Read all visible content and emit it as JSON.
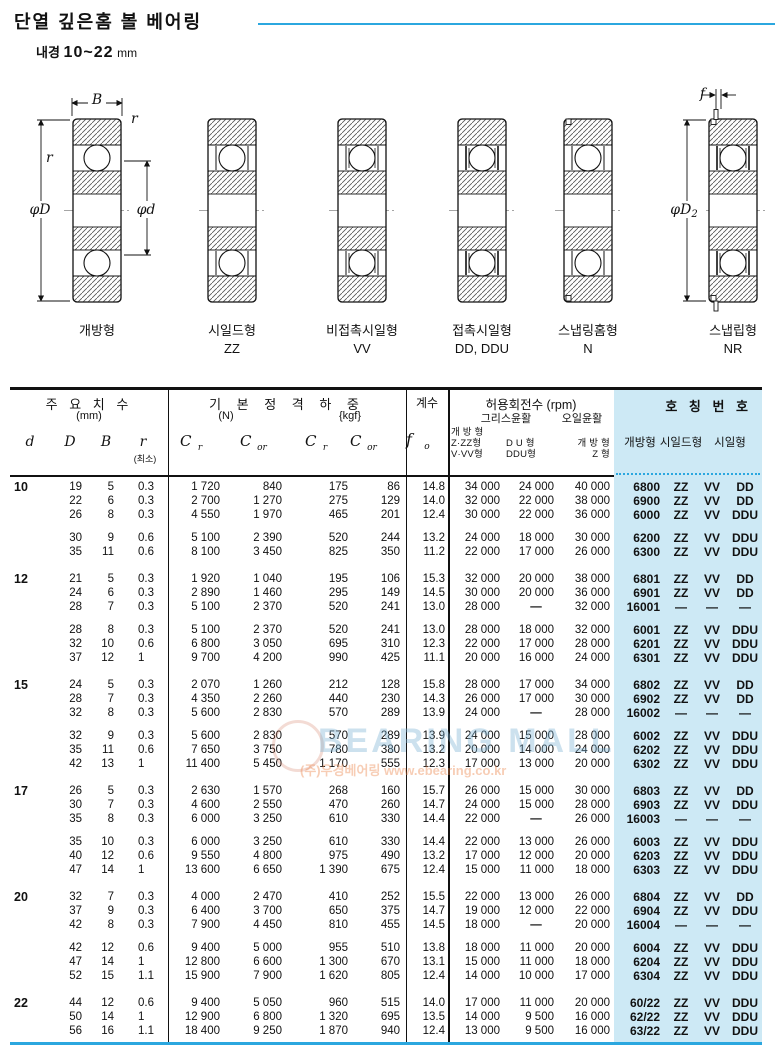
{
  "title": {
    "main": "단열 깊은홈 볼 베어링",
    "sub_label": "내경",
    "sub_range": "10~22",
    "sub_unit": "mm"
  },
  "diagrams": [
    {
      "label": "개방형",
      "code": ""
    },
    {
      "label": "시일드형",
      "code": "ZZ"
    },
    {
      "label": "비접촉시일형",
      "code": "VV"
    },
    {
      "label": "접촉시일형",
      "code": "DD, DDU"
    },
    {
      "label": "스냅링홈형",
      "code": "N"
    },
    {
      "label": "스냅립형",
      "code": "NR"
    }
  ],
  "dims": {
    "B": "B",
    "r_top": "r",
    "r_left": "r",
    "phiD": "φD",
    "phid": "φd",
    "f": "f",
    "phiD2_sym": "φD",
    "phiD2_sub": "2"
  },
  "header": {
    "dims_title": "주 요 치 수",
    "dims_unit": "(mm)",
    "col_d": "d",
    "col_D": "D",
    "col_B": "B",
    "col_r": "r",
    "col_r_min": "(최소)",
    "load_title": "기 본 정 격 하 중",
    "load_unit_n": "(N)",
    "load_unit_kgf": "{kgf}",
    "c_sym": "C",
    "c_sub_r": "r",
    "c_sub_or": "or",
    "factor_title": "계수",
    "f_sym": "f",
    "f_sub": "o",
    "rpm_title": "허용회전수 (rpm)",
    "grease": "그리스윤활",
    "oil": "오일윤활",
    "g1_l1": "개 방 형",
    "g1_l2": "Z·ZZ형",
    "g1_l3": "V·VV형",
    "g2_l1": "D U 형",
    "g2_l2": "DDU형",
    "o_l1": "개 방 형",
    "o_l2": "Z 형",
    "no_title": "호 칭 번 호",
    "no_open": "개방형",
    "no_shield": "시일드형",
    "no_seal": "시일형"
  },
  "colors": {
    "accent": "#2BA7DF",
    "number_panel_bg": "#CDE9F5"
  },
  "watermark": {
    "line1": "BEARING MALL",
    "line2": "(주)우경베어링  www.ebearing.co.kr"
  },
  "table": {
    "groups": [
      {
        "d": "10",
        "subgroups": [
          {
            "rows": [
              {
                "D": "19",
                "B": "5",
                "r": "0.3",
                "cr": "1 720",
                "cor": "840",
                "crk": "175",
                "cork": "86",
                "fo": "14.8",
                "g1": "34 000",
                "g2": "24 000",
                "oil": "40 000",
                "no": "6800",
                "zz": "ZZ",
                "vv": "VV",
                "dd": "DD"
              },
              {
                "D": "22",
                "B": "6",
                "r": "0.3",
                "cr": "2 700",
                "cor": "1 270",
                "crk": "275",
                "cork": "129",
                "fo": "14.0",
                "g1": "32 000",
                "g2": "22 000",
                "oil": "38 000",
                "no": "6900",
                "zz": "ZZ",
                "vv": "VV",
                "dd": "DD"
              },
              {
                "D": "26",
                "B": "8",
                "r": "0.3",
                "cr": "4 550",
                "cor": "1 970",
                "crk": "465",
                "cork": "201",
                "fo": "12.4",
                "g1": "30 000",
                "g2": "22 000",
                "oil": "36 000",
                "no": "6000",
                "zz": "ZZ",
                "vv": "VV",
                "dd": "DDU"
              }
            ]
          },
          {
            "rows": [
              {
                "D": "30",
                "B": "9",
                "r": "0.6",
                "cr": "5 100",
                "cor": "2 390",
                "crk": "520",
                "cork": "244",
                "fo": "13.2",
                "g1": "24 000",
                "g2": "18 000",
                "oil": "30 000",
                "no": "6200",
                "zz": "ZZ",
                "vv": "VV",
                "dd": "DDU"
              },
              {
                "D": "35",
                "B": "11",
                "r": "0.6",
                "cr": "8 100",
                "cor": "3 450",
                "crk": "825",
                "cork": "350",
                "fo": "11.2",
                "g1": "22 000",
                "g2": "17 000",
                "oil": "26 000",
                "no": "6300",
                "zz": "ZZ",
                "vv": "VV",
                "dd": "DDU"
              }
            ]
          }
        ]
      },
      {
        "d": "12",
        "subgroups": [
          {
            "rows": [
              {
                "D": "21",
                "B": "5",
                "r": "0.3",
                "cr": "1 920",
                "cor": "1 040",
                "crk": "195",
                "cork": "106",
                "fo": "15.3",
                "g1": "32 000",
                "g2": "20 000",
                "oil": "38 000",
                "no": "6801",
                "zz": "ZZ",
                "vv": "VV",
                "dd": "DD"
              },
              {
                "D": "24",
                "B": "6",
                "r": "0.3",
                "cr": "2 890",
                "cor": "1 460",
                "crk": "295",
                "cork": "149",
                "fo": "14.5",
                "g1": "30 000",
                "g2": "20 000",
                "oil": "36 000",
                "no": "6901",
                "zz": "ZZ",
                "vv": "VV",
                "dd": "DD"
              },
              {
                "D": "28",
                "B": "7",
                "r": "0.3",
                "cr": "5 100",
                "cor": "2 370",
                "crk": "520",
                "cork": "241",
                "fo": "13.0",
                "g1": "28 000",
                "g2": "—",
                "oil": "32 000",
                "no": "16001",
                "zz": "—",
                "vv": "—",
                "dd": "—"
              }
            ]
          },
          {
            "rows": [
              {
                "D": "28",
                "B": "8",
                "r": "0.3",
                "cr": "5 100",
                "cor": "2 370",
                "crk": "520",
                "cork": "241",
                "fo": "13.0",
                "g1": "28 000",
                "g2": "18 000",
                "oil": "32 000",
                "no": "6001",
                "zz": "ZZ",
                "vv": "VV",
                "dd": "DDU"
              },
              {
                "D": "32",
                "B": "10",
                "r": "0.6",
                "cr": "6 800",
                "cor": "3 050",
                "crk": "695",
                "cork": "310",
                "fo": "12.3",
                "g1": "22 000",
                "g2": "17 000",
                "oil": "28 000",
                "no": "6201",
                "zz": "ZZ",
                "vv": "VV",
                "dd": "DDU"
              },
              {
                "D": "37",
                "B": "12",
                "r": "1",
                "cr": "9 700",
                "cor": "4 200",
                "crk": "990",
                "cork": "425",
                "fo": "11.1",
                "g1": "20 000",
                "g2": "16 000",
                "oil": "24 000",
                "no": "6301",
                "zz": "ZZ",
                "vv": "VV",
                "dd": "DDU"
              }
            ]
          }
        ]
      },
      {
        "d": "15",
        "subgroups": [
          {
            "rows": [
              {
                "D": "24",
                "B": "5",
                "r": "0.3",
                "cr": "2 070",
                "cor": "1 260",
                "crk": "212",
                "cork": "128",
                "fo": "15.8",
                "g1": "28 000",
                "g2": "17 000",
                "oil": "34 000",
                "no": "6802",
                "zz": "ZZ",
                "vv": "VV",
                "dd": "DD"
              },
              {
                "D": "28",
                "B": "7",
                "r": "0.3",
                "cr": "4 350",
                "cor": "2 260",
                "crk": "440",
                "cork": "230",
                "fo": "14.3",
                "g1": "26 000",
                "g2": "17 000",
                "oil": "30 000",
                "no": "6902",
                "zz": "ZZ",
                "vv": "VV",
                "dd": "DD"
              },
              {
                "D": "32",
                "B": "8",
                "r": "0.3",
                "cr": "5 600",
                "cor": "2 830",
                "crk": "570",
                "cork": "289",
                "fo": "13.9",
                "g1": "24 000",
                "g2": "—",
                "oil": "28 000",
                "no": "16002",
                "zz": "—",
                "vv": "—",
                "dd": "—"
              }
            ]
          },
          {
            "rows": [
              {
                "D": "32",
                "B": "9",
                "r": "0.3",
                "cr": "5 600",
                "cor": "2 830",
                "crk": "570",
                "cork": "289",
                "fo": "13.9",
                "g1": "24 000",
                "g2": "15 000",
                "oil": "28 000",
                "no": "6002",
                "zz": "ZZ",
                "vv": "VV",
                "dd": "DDU"
              },
              {
                "D": "35",
                "B": "11",
                "r": "0.6",
                "cr": "7 650",
                "cor": "3 750",
                "crk": "780",
                "cork": "380",
                "fo": "13.2",
                "g1": "20 000",
                "g2": "14 000",
                "oil": "24 000",
                "no": "6202",
                "zz": "ZZ",
                "vv": "VV",
                "dd": "DDU"
              },
              {
                "D": "42",
                "B": "13",
                "r": "1",
                "cr": "11 400",
                "cor": "5 450",
                "crk": "1 170",
                "cork": "555",
                "fo": "12.3",
                "g1": "17 000",
                "g2": "13 000",
                "oil": "20 000",
                "no": "6302",
                "zz": "ZZ",
                "vv": "VV",
                "dd": "DDU"
              }
            ]
          }
        ]
      },
      {
        "d": "17",
        "subgroups": [
          {
            "rows": [
              {
                "D": "26",
                "B": "5",
                "r": "0.3",
                "cr": "2 630",
                "cor": "1 570",
                "crk": "268",
                "cork": "160",
                "fo": "15.7",
                "g1": "26 000",
                "g2": "15 000",
                "oil": "30 000",
                "no": "6803",
                "zz": "ZZ",
                "vv": "VV",
                "dd": "DD"
              },
              {
                "D": "30",
                "B": "7",
                "r": "0.3",
                "cr": "4 600",
                "cor": "2 550",
                "crk": "470",
                "cork": "260",
                "fo": "14.7",
                "g1": "24 000",
                "g2": "15 000",
                "oil": "28 000",
                "no": "6903",
                "zz": "ZZ",
                "vv": "VV",
                "dd": "DDU"
              },
              {
                "D": "35",
                "B": "8",
                "r": "0.3",
                "cr": "6 000",
                "cor": "3 250",
                "crk": "610",
                "cork": "330",
                "fo": "14.4",
                "g1": "22 000",
                "g2": "—",
                "oil": "26 000",
                "no": "16003",
                "zz": "—",
                "vv": "—",
                "dd": "—"
              }
            ]
          },
          {
            "rows": [
              {
                "D": "35",
                "B": "10",
                "r": "0.3",
                "cr": "6 000",
                "cor": "3 250",
                "crk": "610",
                "cork": "330",
                "fo": "14.4",
                "g1": "22 000",
                "g2": "13 000",
                "oil": "26 000",
                "no": "6003",
                "zz": "ZZ",
                "vv": "VV",
                "dd": "DDU"
              },
              {
                "D": "40",
                "B": "12",
                "r": "0.6",
                "cr": "9 550",
                "cor": "4 800",
                "crk": "975",
                "cork": "490",
                "fo": "13.2",
                "g1": "17 000",
                "g2": "12 000",
                "oil": "20 000",
                "no": "6203",
                "zz": "ZZ",
                "vv": "VV",
                "dd": "DDU"
              },
              {
                "D": "47",
                "B": "14",
                "r": "1",
                "cr": "13 600",
                "cor": "6 650",
                "crk": "1 390",
                "cork": "675",
                "fo": "12.4",
                "g1": "15 000",
                "g2": "11 000",
                "oil": "18 000",
                "no": "6303",
                "zz": "ZZ",
                "vv": "VV",
                "dd": "DDU"
              }
            ]
          }
        ]
      },
      {
        "d": "20",
        "subgroups": [
          {
            "rows": [
              {
                "D": "32",
                "B": "7",
                "r": "0.3",
                "cr": "4 000",
                "cor": "2 470",
                "crk": "410",
                "cork": "252",
                "fo": "15.5",
                "g1": "22 000",
                "g2": "13 000",
                "oil": "26 000",
                "no": "6804",
                "zz": "ZZ",
                "vv": "VV",
                "dd": "DD"
              },
              {
                "D": "37",
                "B": "9",
                "r": "0.3",
                "cr": "6 400",
                "cor": "3 700",
                "crk": "650",
                "cork": "375",
                "fo": "14.7",
                "g1": "19 000",
                "g2": "12 000",
                "oil": "22 000",
                "no": "6904",
                "zz": "ZZ",
                "vv": "VV",
                "dd": "DDU"
              },
              {
                "D": "42",
                "B": "8",
                "r": "0.3",
                "cr": "7 900",
                "cor": "4 450",
                "crk": "810",
                "cork": "455",
                "fo": "14.5",
                "g1": "18 000",
                "g2": "—",
                "oil": "20 000",
                "no": "16004",
                "zz": "—",
                "vv": "—",
                "dd": "—"
              }
            ]
          },
          {
            "rows": [
              {
                "D": "42",
                "B": "12",
                "r": "0.6",
                "cr": "9 400",
                "cor": "5 000",
                "crk": "955",
                "cork": "510",
                "fo": "13.8",
                "g1": "18 000",
                "g2": "11 000",
                "oil": "20 000",
                "no": "6004",
                "zz": "ZZ",
                "vv": "VV",
                "dd": "DDU"
              },
              {
                "D": "47",
                "B": "14",
                "r": "1",
                "cr": "12 800",
                "cor": "6 600",
                "crk": "1 300",
                "cork": "670",
                "fo": "13.1",
                "g1": "15 000",
                "g2": "11 000",
                "oil": "18 000",
                "no": "6204",
                "zz": "ZZ",
                "vv": "VV",
                "dd": "DDU"
              },
              {
                "D": "52",
                "B": "15",
                "r": "1.1",
                "cr": "15 900",
                "cor": "7 900",
                "crk": "1 620",
                "cork": "805",
                "fo": "12.4",
                "g1": "14 000",
                "g2": "10 000",
                "oil": "17 000",
                "no": "6304",
                "zz": "ZZ",
                "vv": "VV",
                "dd": "DDU"
              }
            ]
          }
        ]
      },
      {
        "d": "22",
        "subgroups": [
          {
            "rows": [
              {
                "D": "44",
                "B": "12",
                "r": "0.6",
                "cr": "9 400",
                "cor": "5 050",
                "crk": "960",
                "cork": "515",
                "fo": "14.0",
                "g1": "17 000",
                "g2": "11 000",
                "oil": "20 000",
                "no": "60/22",
                "zz": "ZZ",
                "vv": "VV",
                "dd": "DDU"
              },
              {
                "D": "50",
                "B": "14",
                "r": "1",
                "cr": "12 900",
                "cor": "6 800",
                "crk": "1 320",
                "cork": "695",
                "fo": "13.5",
                "g1": "14 000",
                "g2": "9 500",
                "oil": "16 000",
                "no": "62/22",
                "zz": "ZZ",
                "vv": "VV",
                "dd": "DDU"
              },
              {
                "D": "56",
                "B": "16",
                "r": "1.1",
                "cr": "18 400",
                "cor": "9 250",
                "crk": "1 870",
                "cork": "940",
                "fo": "12.4",
                "g1": "13 000",
                "g2": "9 500",
                "oil": "16 000",
                "no": "63/22",
                "zz": "ZZ",
                "vv": "VV",
                "dd": "DDU"
              }
            ]
          }
        ]
      }
    ]
  }
}
